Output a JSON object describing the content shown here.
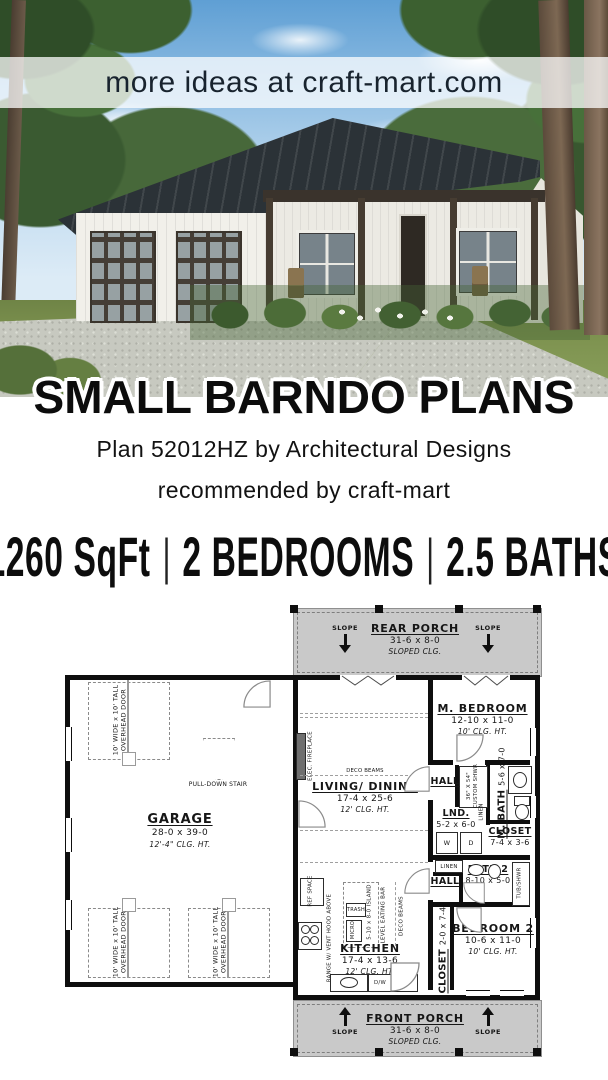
{
  "banner": {
    "text": "more ideas at craft-mart.com"
  },
  "title": "SMALL BARNDO PLANS",
  "subtitle": "Plan 52012HZ by Architectural Designs",
  "recommendation": "recommended by craft-mart",
  "stats": {
    "sqft": "1260 SqFt",
    "bedrooms": "2 BEDROOMS",
    "baths": "2.5 BATHS",
    "separator": "|"
  },
  "plan": {
    "rear_porch": {
      "name": "REAR PORCH",
      "dims": "31-6 x 8-0",
      "clg": "SLOPED CLG."
    },
    "front_porch": {
      "name": "FRONT PORCH",
      "dims": "31-6 x 8-0",
      "clg": "SLOPED CLG."
    },
    "slope": "SLOPE",
    "garage": {
      "name": "GARAGE",
      "dims": "28-0 x 39-0",
      "clg": "12'-4\" CLG. HT."
    },
    "overhead_door_l1": "10' WIDE x 10' TALL",
    "overhead_door_l2": "OVERHEAD DOOR",
    "pull_down_stair": "PULL-DOWN STAIR",
    "living": {
      "name": "LIVING/ DINING",
      "dims": "17-4 x 25-6",
      "clg": "12' CLG. HT."
    },
    "elec_fireplace": "ELEC. FIREPLACE",
    "deco_beams": "DECO BEAMS",
    "m_bedroom": {
      "name": "M. BEDROOM",
      "dims": "12-10 x 11-0",
      "clg": "10' CLG. HT."
    },
    "hall": "HALL",
    "m_bath": {
      "name": "M. BATH",
      "dims": "5-6 x 7-0"
    },
    "custom_shwr_l1": "36\" X 54\"",
    "custom_shwr_l2": "CUSTOM SHWR",
    "linen": "LINEN",
    "lnd": {
      "name": "LND.",
      "dims": "5-2 x 6-0"
    },
    "washer": "W",
    "dryer": "D",
    "closet_m": {
      "name": "CLOSET",
      "dims": "7-4 x 3-6"
    },
    "bath2": {
      "name": "BATH 2",
      "dims": "8-10 x 5-0"
    },
    "tub_shwr": "TUB/SHWR",
    "bedroom2": {
      "name": "BEDROOM 2",
      "dims": "10-6 x 11-0",
      "clg": "10' CLG. HT."
    },
    "closet2": {
      "name": "CLOSET",
      "dims": "2-0 x 7-4"
    },
    "kitchen": {
      "name": "KITCHEN",
      "dims": "17-4 x 13-6",
      "clg": "12' CLG. HT."
    },
    "island": "5-10 x 8-0 ISLAND",
    "eating_bar": "LEVEL EATING BAR",
    "trash": "TRASH",
    "micro": "MICRO",
    "ref_space": "REF SPACE",
    "range": "RANGE W/ VENT HOOD ABOVE",
    "dw": "D/W",
    "pan": "PAN"
  },
  "colors": {
    "banner_text": "#18232e",
    "porch_fill": "#c9c9c9",
    "wall": "#0e0e0e",
    "roof": "#2b3237"
  }
}
